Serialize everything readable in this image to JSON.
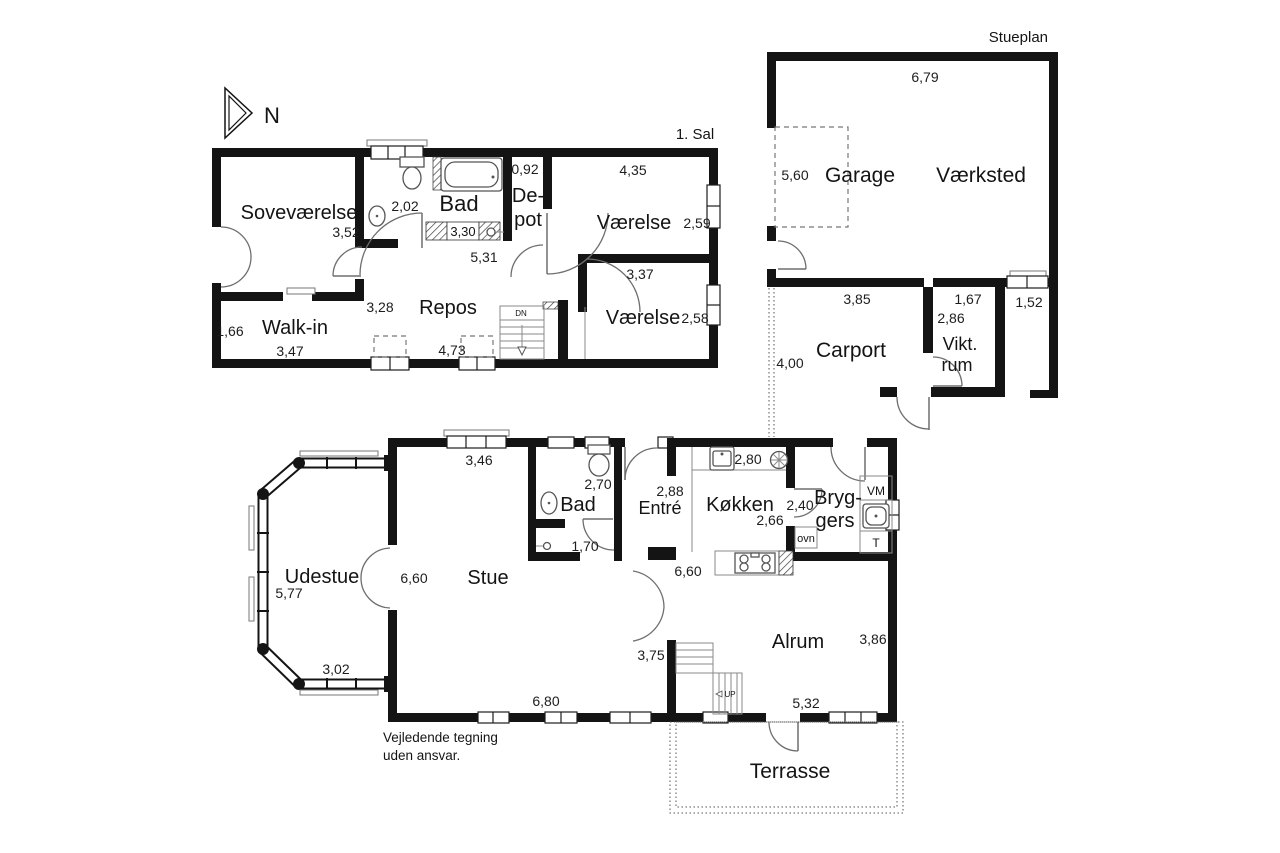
{
  "plan_titles": {
    "upper": "1. Sal",
    "outbuilding": "Stueplan"
  },
  "compass": {
    "north": "N"
  },
  "upper": {
    "sovevaerelse": {
      "name": "Soveværelse",
      "width": "3,52"
    },
    "walkin": {
      "name": "Walk-in",
      "depth": "1,66",
      "width": "3,47"
    },
    "bad": {
      "name": "Bad",
      "width": "2,02",
      "inner": "3,30"
    },
    "depot": {
      "name_l1": "De-",
      "name_l2": "pot",
      "width": "0,92"
    },
    "vaerelse_ne": {
      "name": "Værelse",
      "width": "4,35",
      "depth": "2,59"
    },
    "vaerelse_se": {
      "name": "Værelse",
      "width": "3,37",
      "depth": "2,58"
    },
    "repos": {
      "name": "Repos",
      "width": "5,31",
      "depth": "3,28",
      "width2": "4,73"
    },
    "stairs": {
      "label": "DN"
    }
  },
  "outbuilding": {
    "building_width": "6,79",
    "garage": {
      "name": "Garage",
      "door_width": "5,60"
    },
    "vaerksted": {
      "name": "Værksted"
    },
    "carport": {
      "name": "Carport",
      "width": "3,85",
      "depth": "4,00"
    },
    "viktualierum": {
      "name_l1": "Vikt.",
      "name_l2": "rum",
      "width": "1,67",
      "depth": "2,86"
    },
    "passage": {
      "width": "1,52"
    }
  },
  "ground": {
    "udestue": {
      "name": "Udestue",
      "depth": "5,77",
      "width": "3,02"
    },
    "stue": {
      "name": "Stue",
      "width_top": "3,46",
      "width": "6,60",
      "width_bottom": "6,80"
    },
    "bad": {
      "name": "Bad",
      "width": "2,70",
      "inner": "1,70"
    },
    "entre": {
      "name": "Entré",
      "width": "2,88"
    },
    "koekken": {
      "name": "Køkken",
      "width": "2,80",
      "depth": "2,66",
      "oven": "ovn"
    },
    "bryggers": {
      "name_l1": "Bryg-",
      "name_l2": "gers",
      "width": "2,40",
      "washer": "VM",
      "dryer": "T"
    },
    "alrum": {
      "name": "Alrum",
      "width": "6,60",
      "depth": "3,86",
      "hall": "3,75",
      "width_bottom": "5,32",
      "stairs": "UP"
    },
    "terrasse": {
      "name": "Terrasse"
    }
  },
  "disclaimer": {
    "line1": "Vejledende tegning",
    "line2": "uden ansvar."
  }
}
